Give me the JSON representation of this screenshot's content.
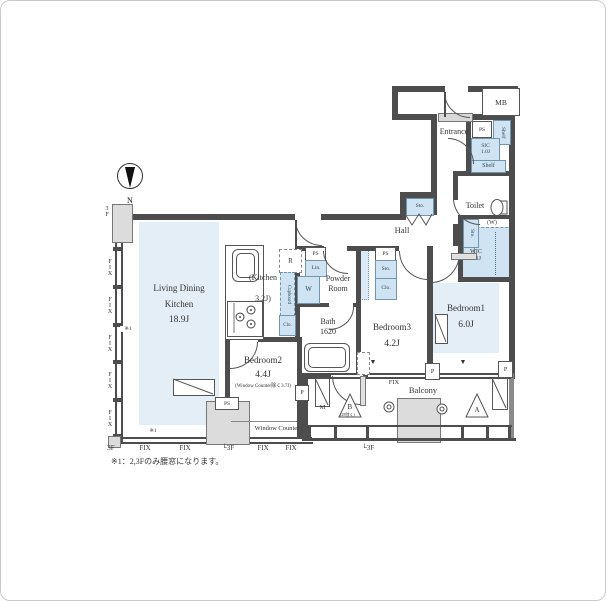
{
  "rooms": {
    "ldk": {
      "l1": "Living Dining",
      "l2": "Kitchen",
      "size": "18.9J"
    },
    "kitchen": {
      "l1": "(Kitchen",
      "l2": "3.2J)"
    },
    "powder": {
      "l1": "Powder",
      "l2": "Room"
    },
    "bath": {
      "name": "Bath",
      "size": "1620"
    },
    "bedroom1": {
      "name": "Bedroom1",
      "size": "6.0J"
    },
    "bedroom2": {
      "name": "Bedroom2",
      "size": "4.4J",
      "note": "(Window Counter除く3.7J)",
      "counter": "Window Counter"
    },
    "bedroom3": {
      "name": "Bedroom3",
      "size": "4.2J"
    },
    "balcony": {
      "name": "Balcony"
    },
    "hall": {
      "name": "Hall"
    },
    "entrance": {
      "name": "Entrance"
    },
    "toilet": {
      "name": "Toilet"
    },
    "wic": {
      "name": "WIC",
      "size": "1.1J"
    },
    "sic": {
      "name": "SIC",
      "size": "1.0J"
    },
    "mb": {
      "name": "MB"
    }
  },
  "fixtures": {
    "shelf": "Shelf",
    "sto": "Sto.",
    "lin": "Lin.",
    "clo": "Clo.",
    "ps": "PS",
    "fridge": "R",
    "washer": "W",
    "meter": "M",
    "cupboard": "Cupboard",
    "window_w": "(W)"
  },
  "markers": {
    "fix": "FIX",
    "floor3": "3F",
    "floor3_corner": "└3F",
    "pillar": "P",
    "tri_a": "A",
    "tri_b": "B",
    "tri_b_note": "(2F除く)",
    "window_down": "▼",
    "north": "N",
    "ref": "※1"
  },
  "note": "※1：2,3Fのみ腰窓になります。",
  "colors": {
    "wall": "#4d4d4d",
    "room_fill": "#e4eef7",
    "fixture_fill": "#cfe3f2",
    "fixture_border": "#7096ad",
    "gray_fill": "#dcdcdc"
  }
}
